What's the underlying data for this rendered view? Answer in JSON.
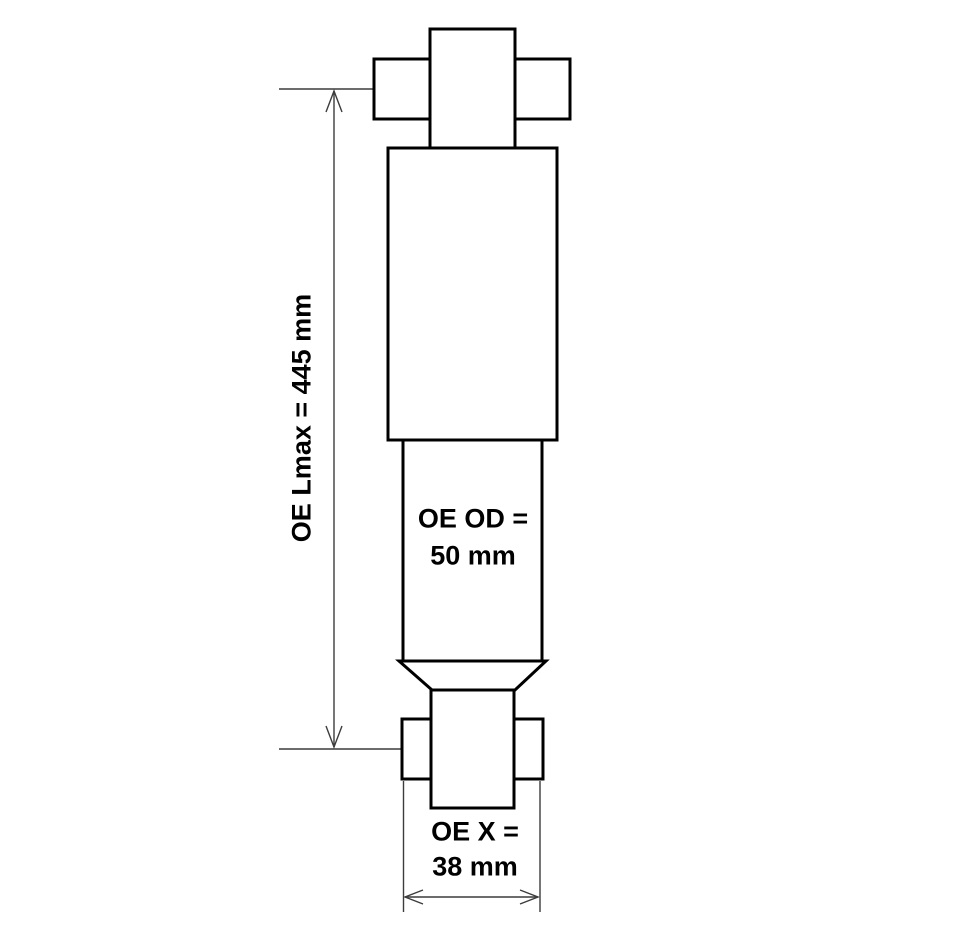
{
  "figure": {
    "title": "shock absorber technical drawing",
    "background_color": "#ffffff",
    "outline_color": "#000000",
    "dimension_line_color": "#3c3c3c",
    "dimensions": {
      "lmax": {
        "label": "OE Lmax = 445 mm",
        "value_mm": 445,
        "orientation": "vertical"
      },
      "od": {
        "label_line1": "OE OD =",
        "label_line2": "50 mm",
        "value_mm": 50,
        "orientation": "horizontal"
      },
      "x": {
        "label_line1": "OE X =",
        "label_line2": "38 mm",
        "value_mm": 38,
        "orientation": "horizontal"
      }
    }
  }
}
